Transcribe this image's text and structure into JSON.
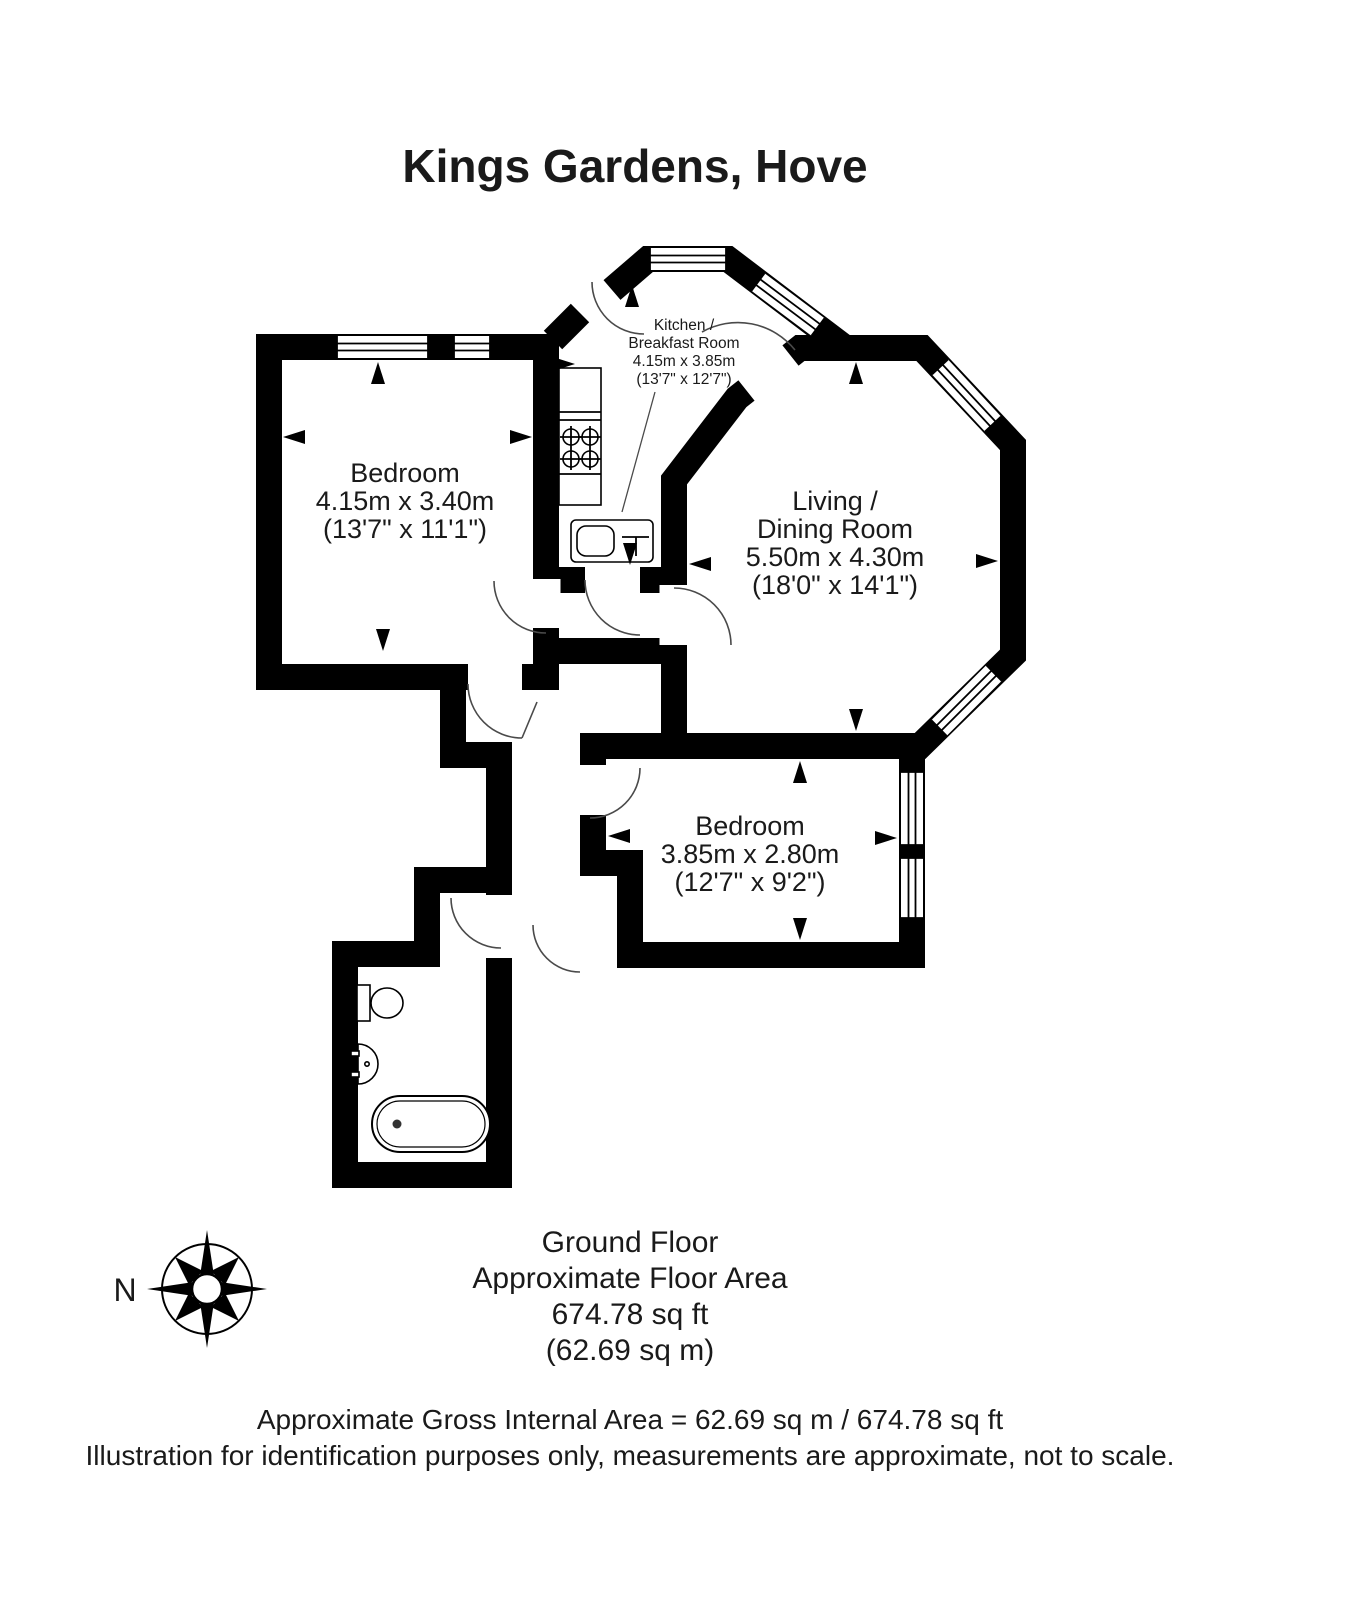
{
  "title": "Kings Gardens, Hove",
  "rooms": {
    "bedroom1": {
      "name": "Bedroom",
      "size_metric": "4.15m x 3.40m",
      "size_imperial": "(13'7\" x 11'1\")"
    },
    "kitchen": {
      "name_line1": "Kitchen /",
      "name_line2": "Breakfast Room",
      "size_metric": "4.15m x 3.85m",
      "size_imperial": "(13'7\" x 12'7\")"
    },
    "living": {
      "name_line1": "Living /",
      "name_line2": "Dining Room",
      "size_metric": "5.50m x 4.30m",
      "size_imperial": "(18'0\" x 14'1\")"
    },
    "bedroom2": {
      "name": "Bedroom",
      "size_metric": "3.85m x 2.80m",
      "size_imperial": "(12'7\" x 9'2\")"
    }
  },
  "footer": {
    "floor_name": "Ground Floor",
    "area_label": "Approximate Floor Area",
    "area_sqft": "674.78 sq ft",
    "area_sqm": "(62.69 sq m)"
  },
  "disclaimer": {
    "line1": "Approximate Gross Internal Area = 62.69 sq m / 674.78 sq ft",
    "line2": "Illustration for identification purposes only, measurements are approximate, not to scale."
  },
  "compass": {
    "north_label": "N"
  },
  "colors": {
    "walls": "#000000",
    "background": "#ffffff"
  }
}
